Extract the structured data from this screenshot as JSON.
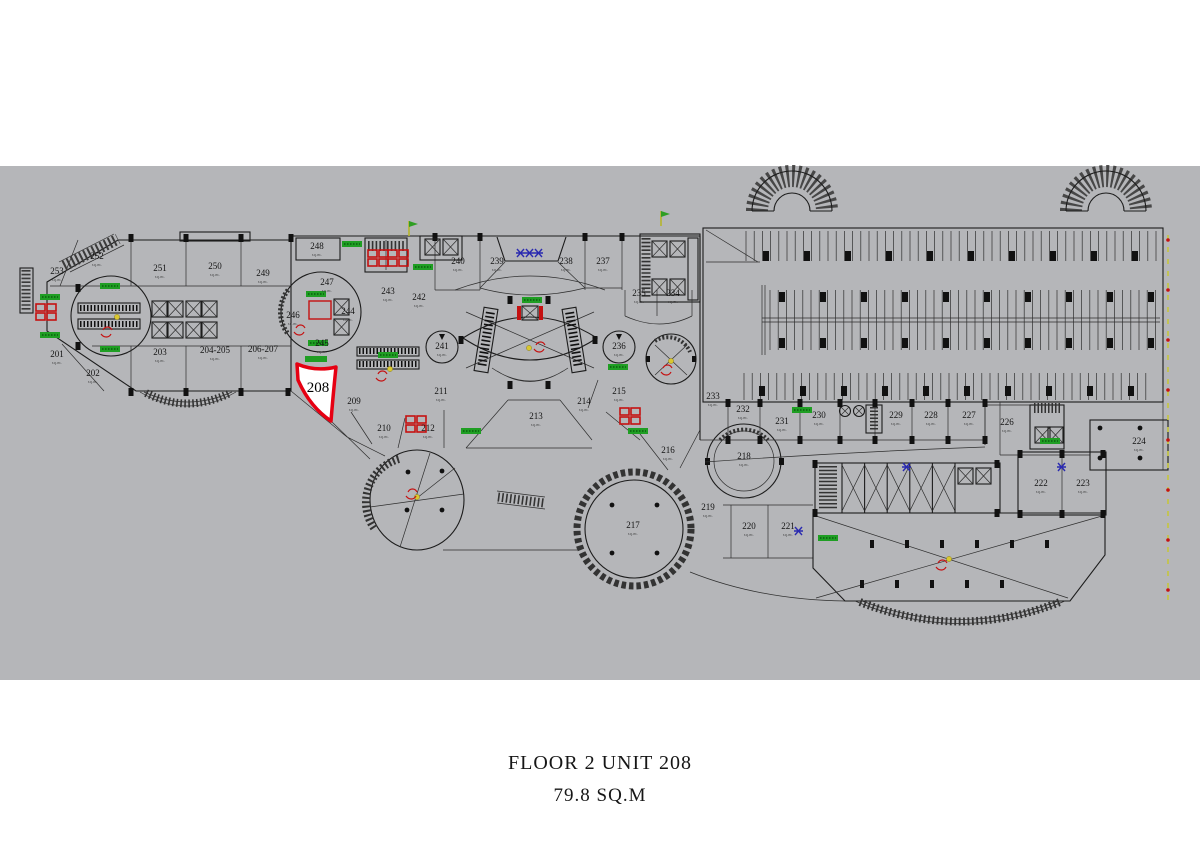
{
  "page": {
    "background": "#ffffff",
    "plan_band_color": "#b5b6b9"
  },
  "caption": {
    "line1": "FLOOR 2 UNIT 208",
    "line2": "79.8 SQ.M"
  },
  "highlight": {
    "unit": "208",
    "outline_color": "#e60012",
    "fill": "#ffffff"
  },
  "floorplan": {
    "colors": {
      "line": "#1c1c1c",
      "green_tag": "#1f9e23",
      "red_icon": "#c51111",
      "yellow_dot": "#d9c72f",
      "blue_mark": "#2a2ab0",
      "boundary_dash": "#c6c63e"
    },
    "icons": [
      "escalator-icon",
      "elevator-icon",
      "stair-icon",
      "wc-icon",
      "ramp-icon",
      "flag-icon",
      "column-icon",
      "boundary-line"
    ],
    "area_suffix": "sq.m.",
    "units": [
      {
        "id": "201",
        "area": "sq.m."
      },
      {
        "id": "202",
        "area": "sq.m."
      },
      {
        "id": "203",
        "area": "sq.m."
      },
      {
        "id": "204-205",
        "area": "sq.m."
      },
      {
        "id": "206-207",
        "area": "sq.m."
      },
      {
        "id": "208",
        "highlight": true
      },
      {
        "id": "209",
        "area": "sq.m."
      },
      {
        "id": "210",
        "area": "sq.m."
      },
      {
        "id": "211",
        "area": "sq.m."
      },
      {
        "id": "212",
        "area": "sq.m."
      },
      {
        "id": "213",
        "area": "sq.m."
      },
      {
        "id": "214",
        "area": "sq.m."
      },
      {
        "id": "215",
        "area": "sq.m."
      },
      {
        "id": "216",
        "area": "sq.m."
      },
      {
        "id": "217",
        "area": "sq.m."
      },
      {
        "id": "218",
        "area": "sq.m."
      },
      {
        "id": "219",
        "area": "sq.m."
      },
      {
        "id": "220",
        "area": "sq.m."
      },
      {
        "id": "221",
        "area": "sq.m."
      },
      {
        "id": "222",
        "area": "sq.m."
      },
      {
        "id": "223",
        "area": "sq.m."
      },
      {
        "id": "224",
        "area": "sq.m."
      },
      {
        "id": "226",
        "area": "sq.m."
      },
      {
        "id": "227",
        "area": "sq.m."
      },
      {
        "id": "228",
        "area": "sq.m."
      },
      {
        "id": "229",
        "area": "sq.m."
      },
      {
        "id": "230",
        "area": "sq.m."
      },
      {
        "id": "231",
        "area": "sq.m."
      },
      {
        "id": "232",
        "area": "sq.m."
      },
      {
        "id": "233",
        "area": "sq.m."
      },
      {
        "id": "234",
        "area": "sq.m."
      },
      {
        "id": "235",
        "area": "sq.m."
      },
      {
        "id": "236",
        "area": "sq.m."
      },
      {
        "id": "237",
        "area": "sq.m."
      },
      {
        "id": "238",
        "area": "sq.m."
      },
      {
        "id": "239",
        "area": "sq.m."
      },
      {
        "id": "240",
        "area": "sq.m."
      },
      {
        "id": "241",
        "area": "sq.m."
      },
      {
        "id": "242",
        "area": "sq.m."
      },
      {
        "id": "243",
        "area": "sq.m."
      },
      {
        "id": "244",
        "area": "sq.m."
      },
      {
        "id": "245",
        "area": "sq.m."
      },
      {
        "id": "246",
        "area": "sq.m."
      },
      {
        "id": "247",
        "area": "sq.m."
      },
      {
        "id": "248",
        "area": "sq.m."
      },
      {
        "id": "249",
        "area": "sq.m."
      },
      {
        "id": "250",
        "area": "sq.m."
      },
      {
        "id": "251",
        "area": "sq.m."
      },
      {
        "id": "252",
        "area": "sq.m."
      },
      {
        "id": "253",
        "area": "sq.m."
      }
    ]
  }
}
